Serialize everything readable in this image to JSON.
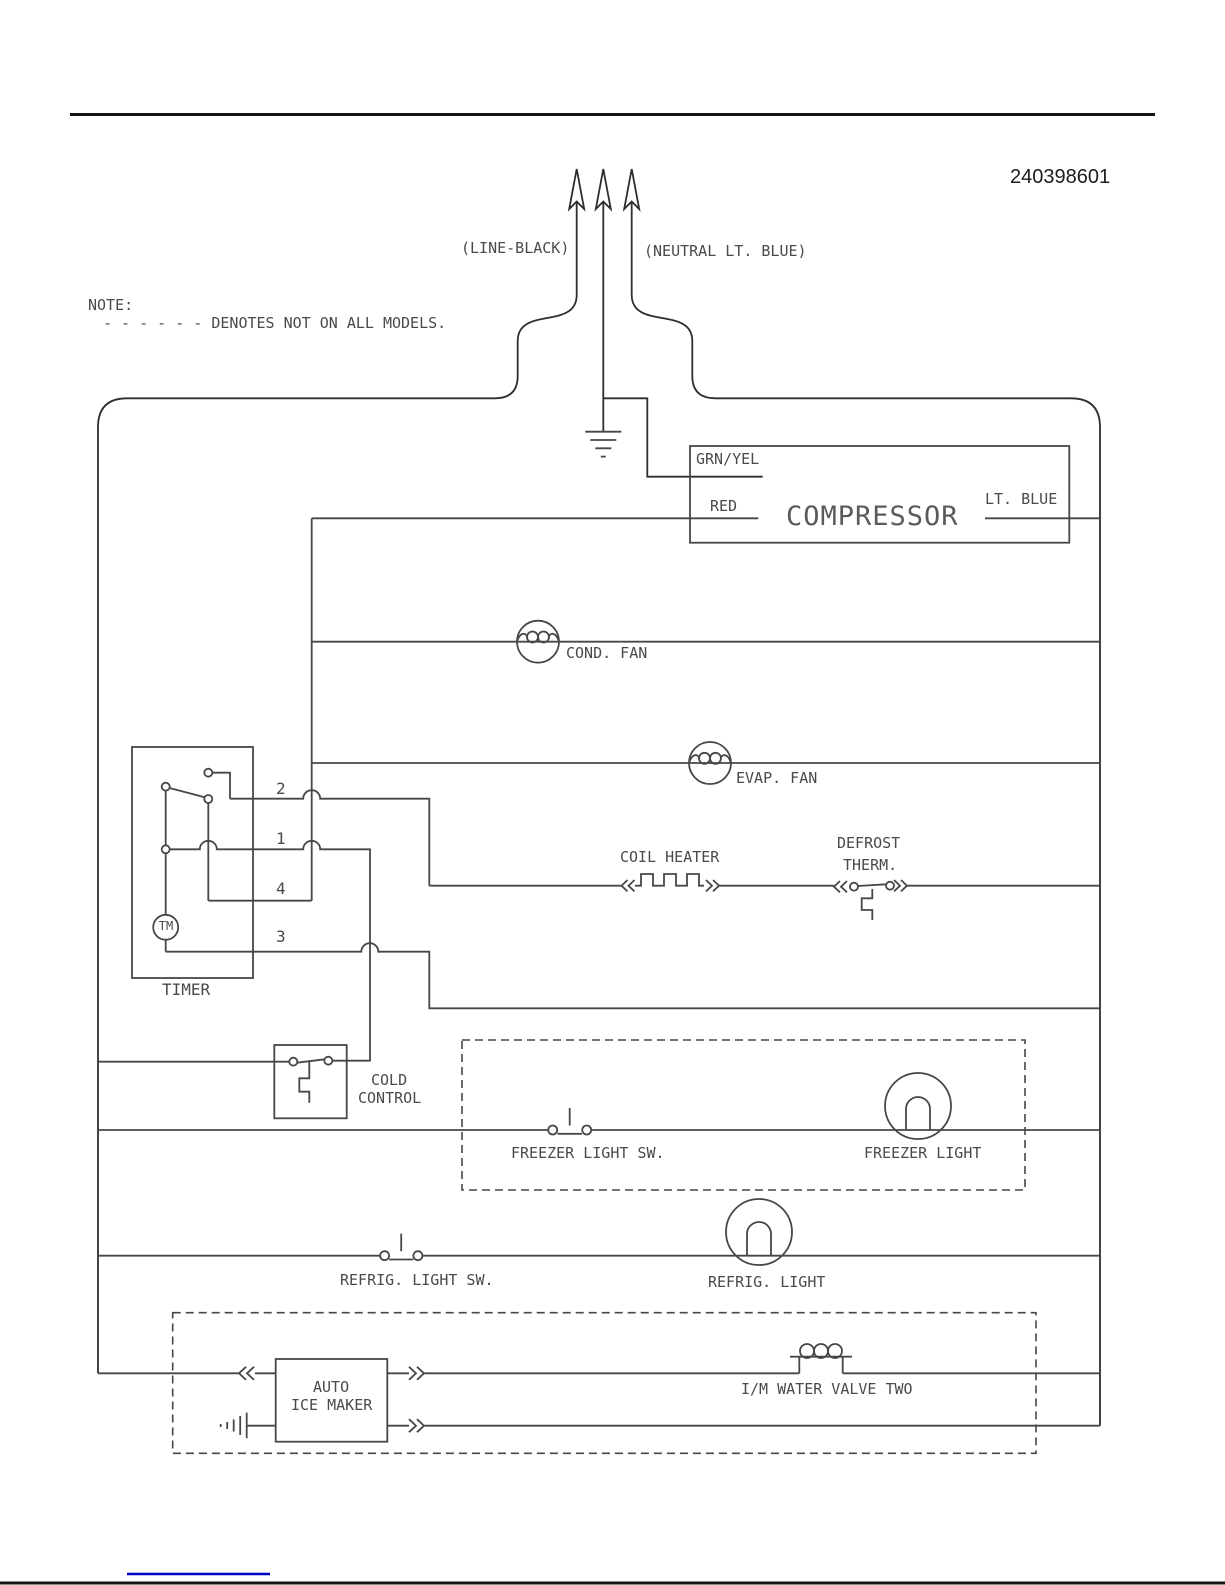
{
  "colors": {
    "line": "#474747",
    "text": "#4a4a4a",
    "rule": "#141414",
    "link": "#0000cc",
    "bg": "#ffffff"
  },
  "header": {
    "part_number": "240398601"
  },
  "note": {
    "heading": "NOTE:",
    "body": "- - - - - - DENOTES NOT ON ALL MODELS."
  },
  "supply": {
    "line_label": "(LINE-BLACK)",
    "neutral_label": "(NEUTRAL LT. BLUE)"
  },
  "components": {
    "compressor": {
      "name": "COMPRESSOR",
      "terminal_ground": "GRN/YEL",
      "terminal_line": "RED",
      "terminal_neutral": "LT. BLUE"
    },
    "cond_fan": {
      "name": "COND. FAN"
    },
    "evap_fan": {
      "name": "EVAP. FAN"
    },
    "timer": {
      "name": "TIMER",
      "motor": "TM",
      "terminals": [
        "2",
        "1",
        "4",
        "3"
      ]
    },
    "coil_heater": {
      "name": "COIL HEATER"
    },
    "defrost_therm": {
      "name_line1": "DEFROST",
      "name_line2": "THERM."
    },
    "cold_control": {
      "name_line1": "COLD",
      "name_line2": "CONTROL"
    },
    "freezer_light_sw": {
      "name": "FREEZER LIGHT SW."
    },
    "freezer_light": {
      "name": "FREEZER LIGHT"
    },
    "refrig_light_sw": {
      "name": "REFRIG. LIGHT SW."
    },
    "refrig_light": {
      "name": "REFRIG. LIGHT"
    },
    "ice_maker": {
      "name_line1": "AUTO",
      "name_line2": "ICE MAKER"
    },
    "water_valve": {
      "name": "I/M WATER VALVE TWO"
    }
  }
}
